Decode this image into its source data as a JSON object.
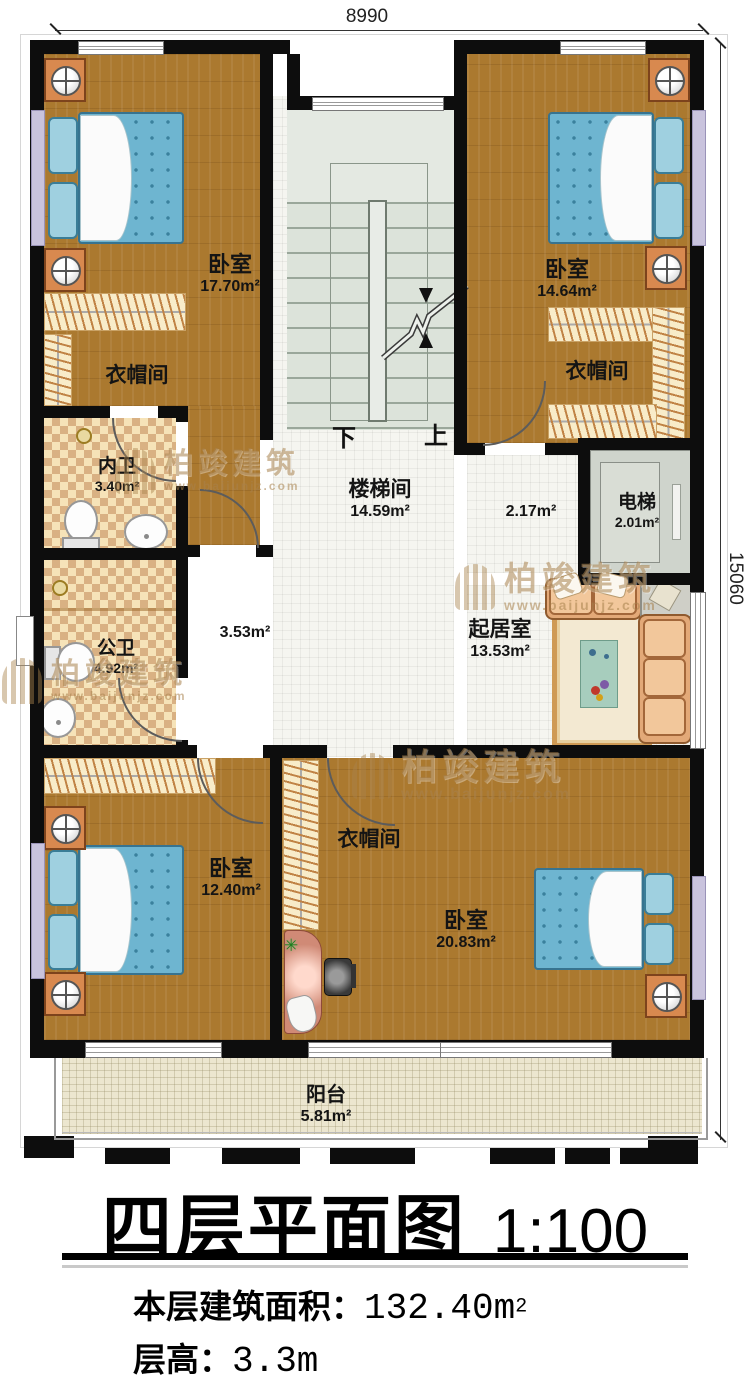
{
  "dimensions": {
    "width_top": "8990",
    "height_right": "15060"
  },
  "stairs": {
    "down": "下",
    "up": "上"
  },
  "rooms": {
    "bedroom_tl": {
      "name": "卧室",
      "area": "17.70m²"
    },
    "cloak_tl": {
      "name": "衣帽间"
    },
    "bedroom_tr": {
      "name": "卧室",
      "area": "14.64m²"
    },
    "cloak_tr": {
      "name": "衣帽间"
    },
    "bath_private": {
      "name": "内卫",
      "area": "3.40m²"
    },
    "bath_public": {
      "name": "公卫",
      "area": "4.92m²"
    },
    "stairwell": {
      "name": "楼梯间",
      "area": "14.59m²"
    },
    "hall_left": {
      "area": "3.53m²"
    },
    "hall_right": {
      "area": "2.17m²"
    },
    "elevator": {
      "name": "电梯",
      "area": "2.01m²"
    },
    "living": {
      "name": "起居室",
      "area": "13.53m²"
    },
    "bedroom_bl": {
      "name": "卧室",
      "area": "12.40m²"
    },
    "cloak_bottom": {
      "name": "衣帽间"
    },
    "bedroom_br": {
      "name": "卧室",
      "area": "20.83m²"
    },
    "balcony": {
      "name": "阳台",
      "area": "5.81m²"
    }
  },
  "watermark": {
    "brand": "柏竣建筑",
    "url": "www.baijunjz.com"
  },
  "icons": {
    "plant": "✳"
  },
  "title": {
    "main": "四层平面图",
    "scale": "1:100"
  },
  "footer": {
    "area_label": "本层建筑面积：",
    "area_value": "132.40m",
    "area_sup": "2",
    "height_label": "层高：",
    "height_value": "3.3m"
  }
}
